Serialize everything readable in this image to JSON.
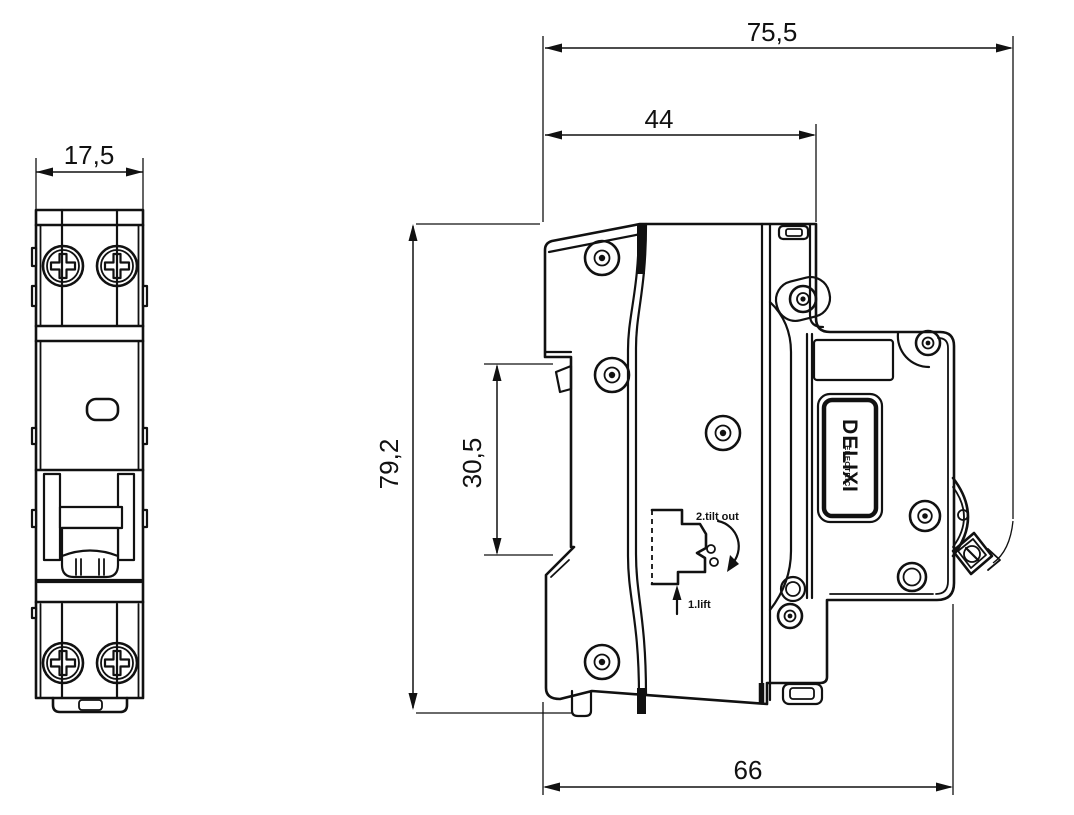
{
  "dimensions": {
    "front_width": "17,5",
    "total_depth": "75,5",
    "upper_depth": "44",
    "height": "79,2",
    "din_gap": "30,5",
    "base_depth": "66"
  },
  "brand": {
    "name": "DELIXI",
    "subtitle": "ELECTRIC"
  },
  "instructions": {
    "step1": "1.lift",
    "step2": "2.tilt out"
  },
  "colors": {
    "line": "#111111",
    "background": "#ffffff"
  }
}
